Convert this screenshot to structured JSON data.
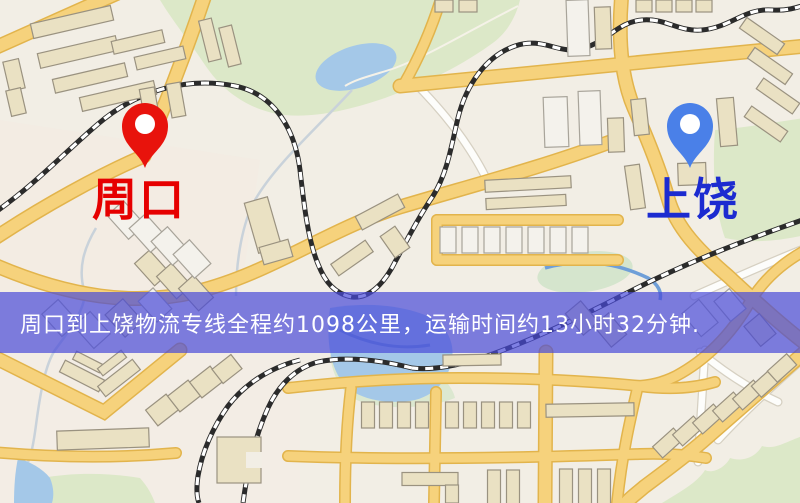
{
  "map": {
    "origin": {
      "name": "周口",
      "pin_color": "#e8130c",
      "label_color": "#e60000"
    },
    "destination": {
      "name": "上饶",
      "pin_color": "#4a80e8",
      "label_color": "#1c2bd0"
    }
  },
  "banner": {
    "text": "周口到上饶物流专线全程约1098公里，运输时间约13小时32分钟.",
    "background": "#4a4ad9",
    "text_color": "#ffffff"
  }
}
